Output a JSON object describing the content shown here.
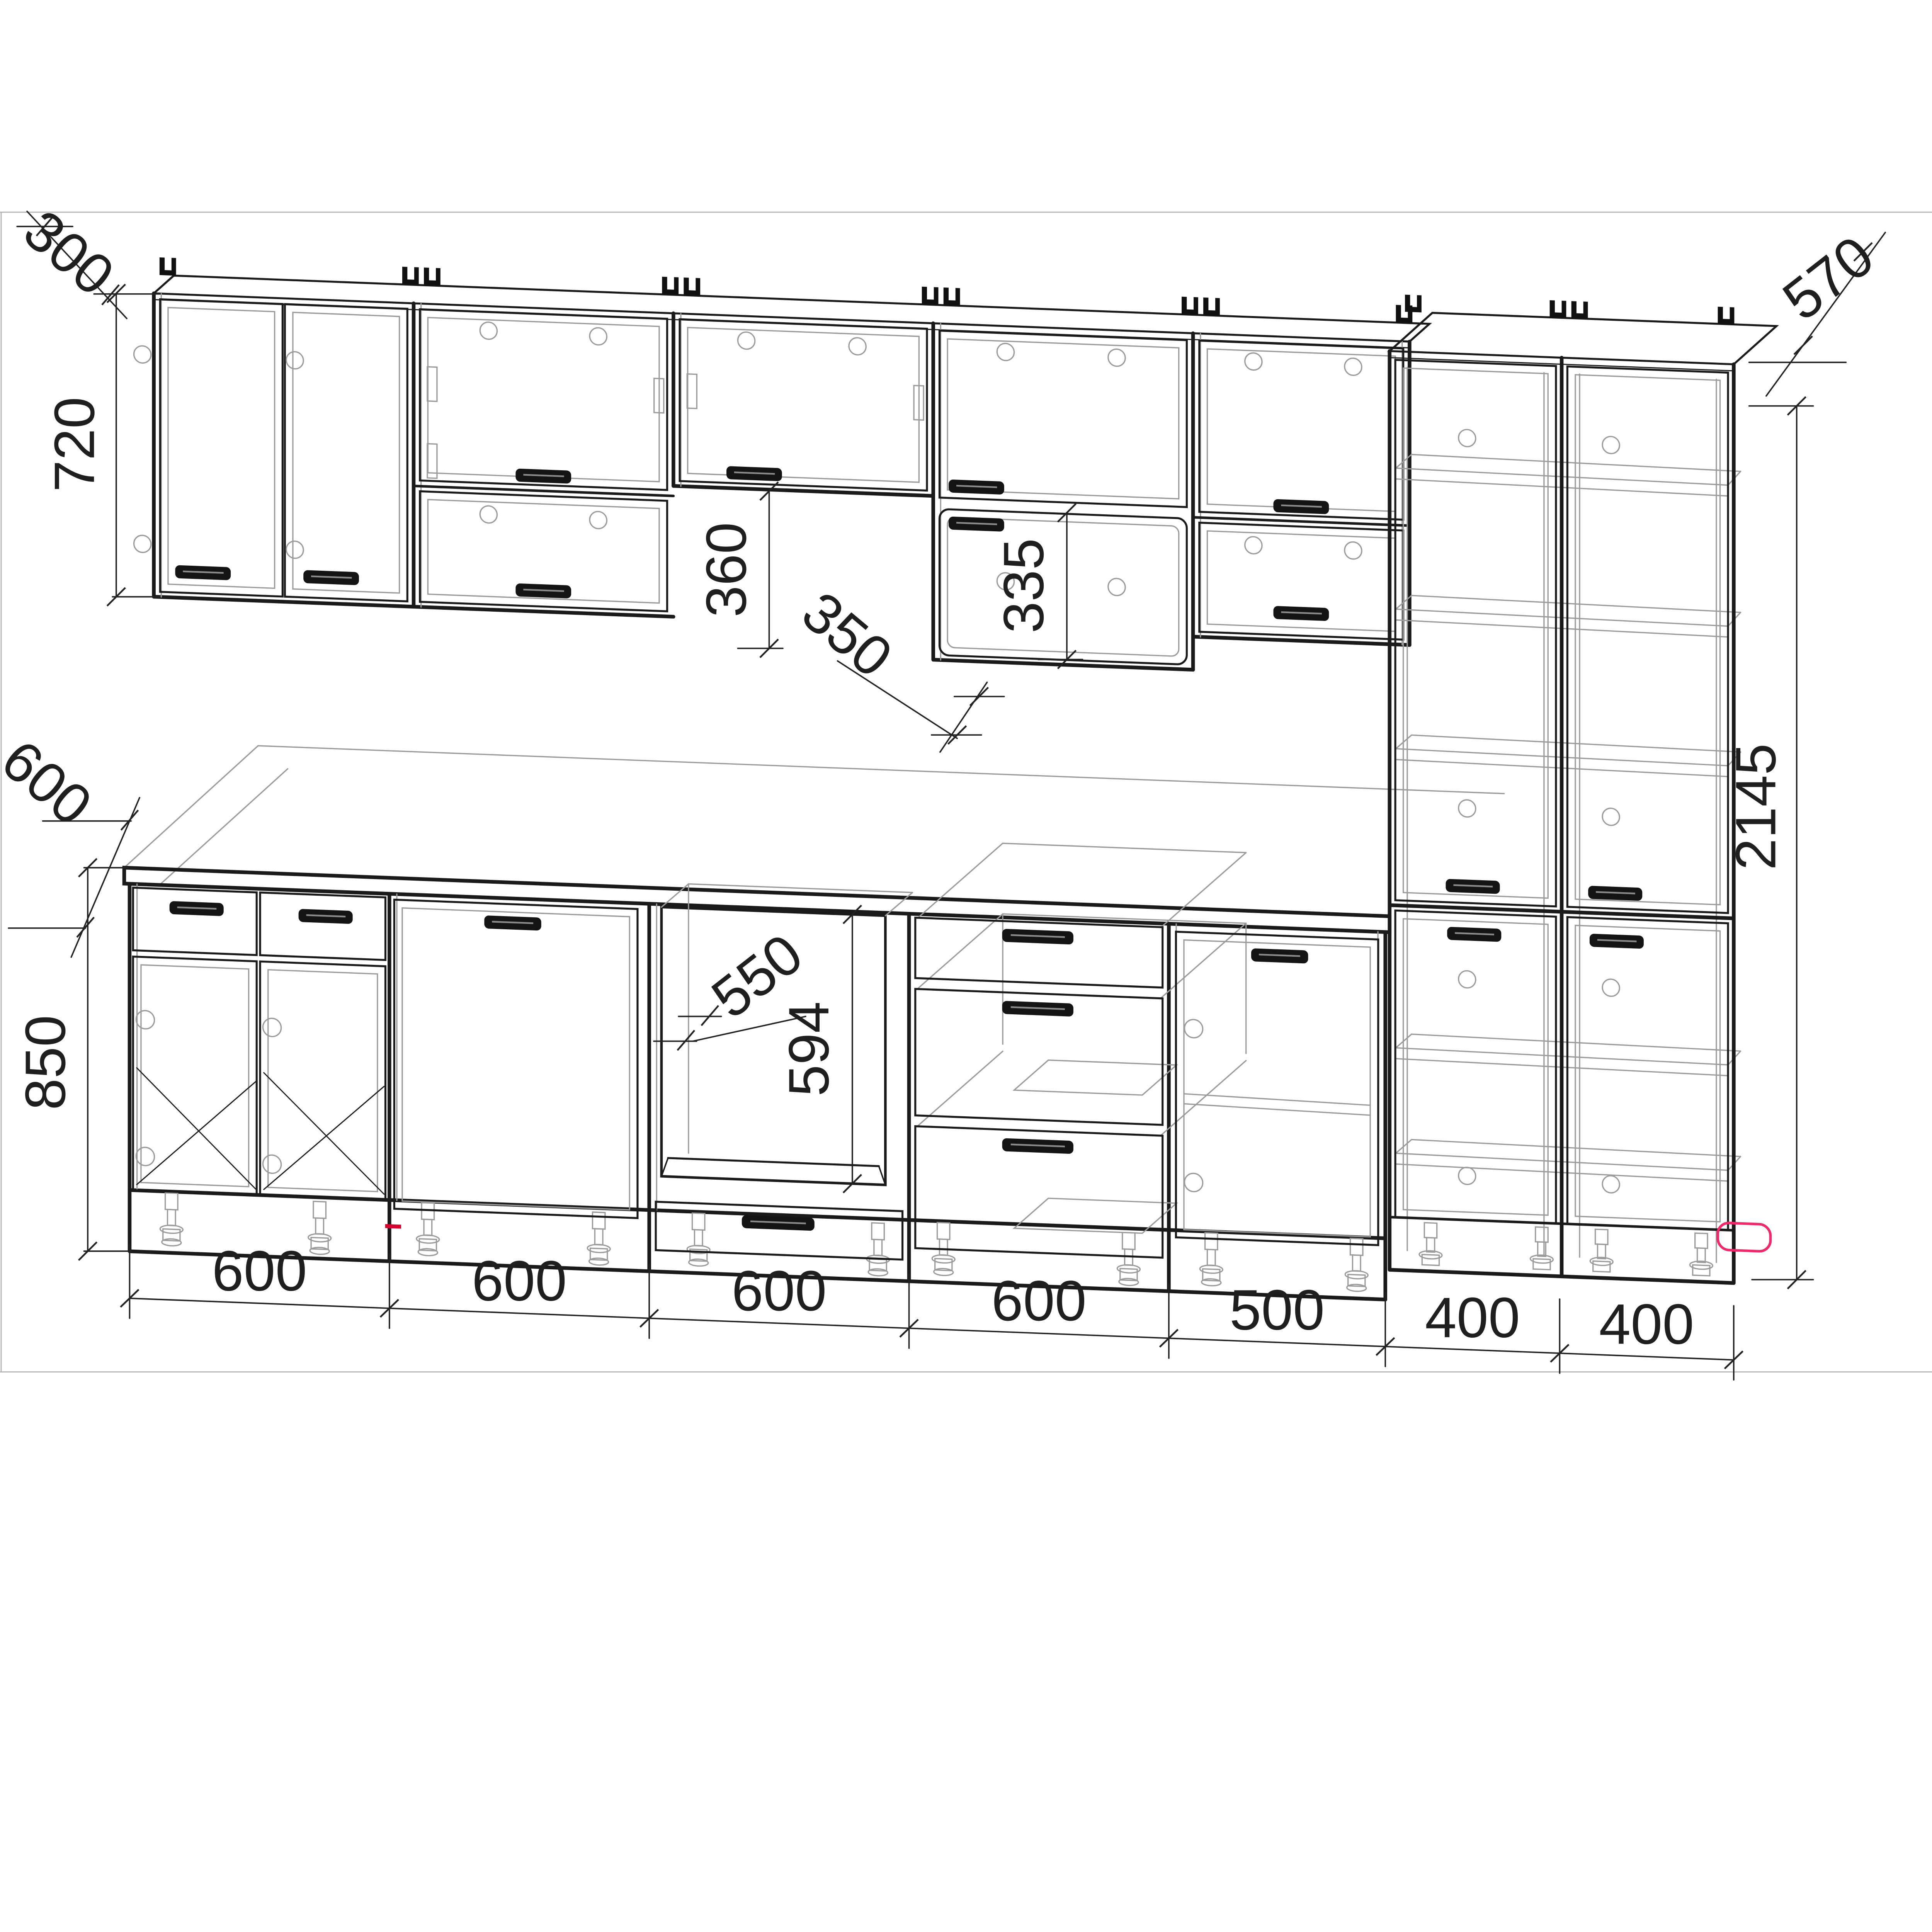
{
  "drawing": {
    "type": "kitchen-cabinet-elevation-wireframe",
    "background": "#ffffff",
    "line_color": "#1a1a1a",
    "hidden_line_color": "#9b9b9b",
    "frame_color": "#b5b5b5",
    "accent_color": "#ED2A6B",
    "dimensions": {
      "wall_cabinet_depth": "300",
      "wall_cabinet_height": "720",
      "hood_gap_height": "360",
      "hood_depth": "350",
      "wall_lower_door_height": "335",
      "tall_cabinet_depth": "570",
      "countertop_depth": "600",
      "base_height": "850",
      "oven_niche_width": "550",
      "oven_niche_height": "594",
      "tall_cabinet_height": "2145",
      "bottom_widths": {
        "w1": "600",
        "w2": "600",
        "w3": "600",
        "w4": "600",
        "w5": "500",
        "w6": "400",
        "w7": "400"
      }
    },
    "components": {
      "wall_row": [
        "double-door wall cabinet 600",
        "two flap wall cabinet 600",
        "hood flap cabinet 600",
        "flap + 335 door cabinet 600",
        "two flap wall cabinet 500"
      ],
      "base_row": [
        "base 600 two drawers + two doors",
        "base 600 full door",
        "oven housing 600 with drawer",
        "drawer base 600 (3 drawers)",
        "base 500 single door"
      ],
      "tall_units": [
        "tall pantry 400",
        "tall pantry 400"
      ]
    }
  }
}
